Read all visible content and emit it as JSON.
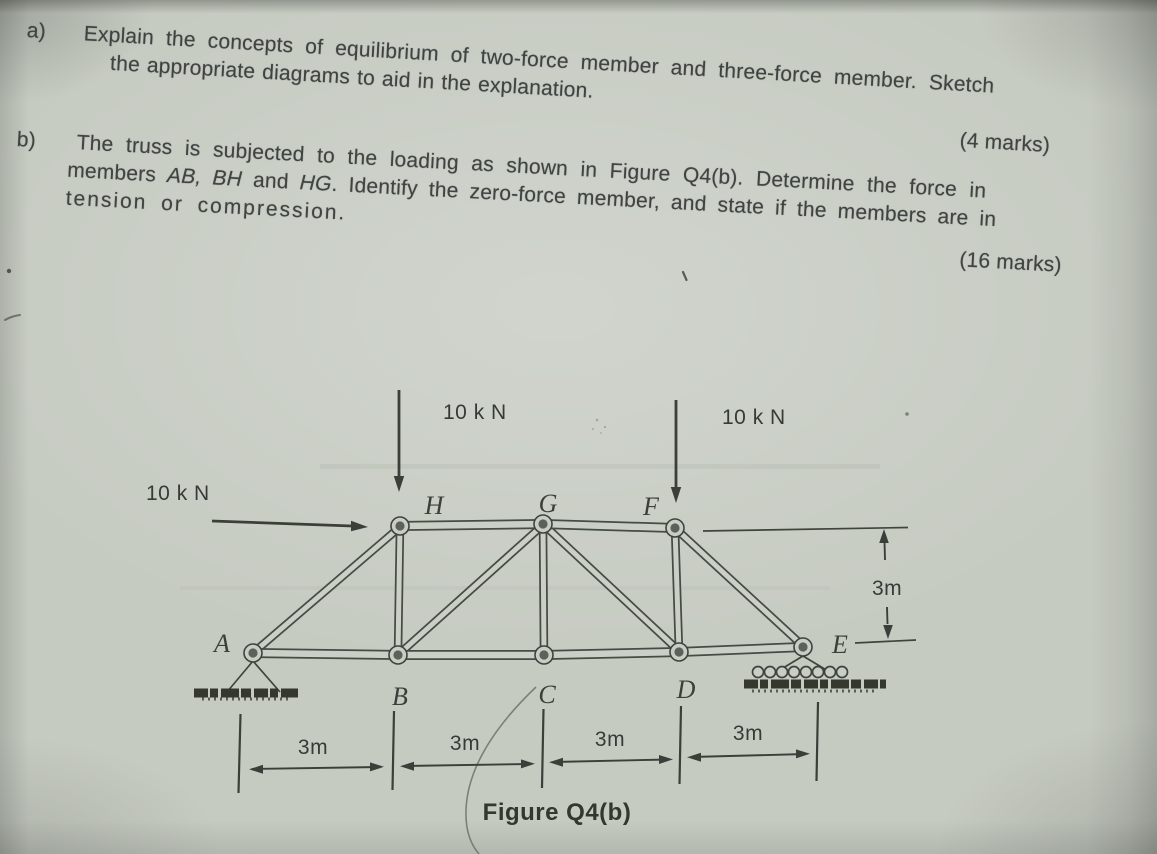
{
  "page": {
    "paper_color": "#c6cbc2",
    "ink_color": "#3f4442"
  },
  "question": {
    "part_a": {
      "label": "a)",
      "line1": "Explain the concepts of equilibrium of two-force member and three-force member. Sketch",
      "line2": "the appropriate diagrams to aid in the explanation.",
      "marks": "(4 marks)"
    },
    "part_b": {
      "label": "b)",
      "line1": "The truss is subjected to the loading as shown in Figure Q4(b). Determine the force in",
      "line2_seg1": "members ",
      "line2_seg2": "AB, BH",
      "line2_seg3": " and ",
      "line2_seg4": "HG",
      "line2_seg5": ". Identify the zero-force member, and state if the members are in",
      "line3": "tension or compression.",
      "marks": "(16 marks)"
    }
  },
  "figure": {
    "caption": "Figure Q4(b)",
    "loads": {
      "left_horizontal": "10 k N",
      "at_H": "10 k N",
      "at_F": "10 k N"
    },
    "dims": {
      "spans": [
        "3m",
        "3m",
        "3m",
        "3m"
      ],
      "height": "3m"
    },
    "nodes": {
      "A": "A",
      "B": "B",
      "C": "C",
      "D": "D",
      "E": "E",
      "F": "F",
      "G": "G",
      "H": "H"
    }
  }
}
